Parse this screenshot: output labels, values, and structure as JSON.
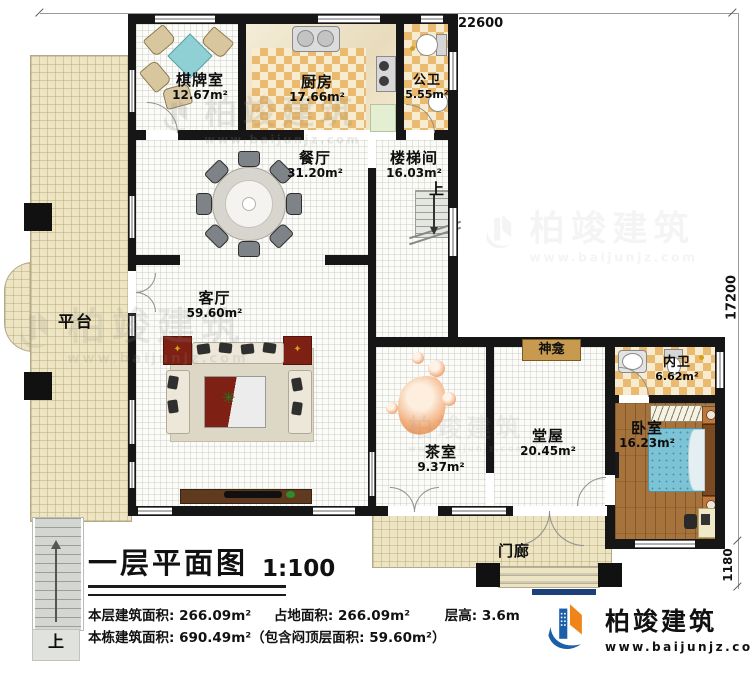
{
  "plan": {
    "dims": {
      "width_top": "22600",
      "height_right": "17200",
      "porch_depth": "1180"
    },
    "rooms": [
      {
        "name": "棋牌室",
        "area": "12.67m²"
      },
      {
        "name": "厨房",
        "area": "17.66m²"
      },
      {
        "name": "公卫",
        "area": "5.55m²"
      },
      {
        "name": "餐厅",
        "area": "31.20m²"
      },
      {
        "name": "楼梯间",
        "area": "16.03m²"
      },
      {
        "name": "客厅",
        "area": "59.60m²"
      },
      {
        "name": "茶室",
        "area": "9.37m²"
      },
      {
        "name": "堂屋",
        "area": "20.45m²"
      },
      {
        "name": "内卫",
        "area": "6.62m²"
      },
      {
        "name": "卧室",
        "area": "16.23m²"
      }
    ],
    "labels": {
      "terrace": "平台",
      "porch": "门廊",
      "shrine": "神龛",
      "up": "上"
    }
  },
  "title_block": {
    "title": "一层平面图",
    "scale": "1:100",
    "stats": [
      "本层建筑面积: 266.09m²",
      "占地面积: 266.09m²",
      "层高: 3.6m"
    ],
    "line2": "本栋建筑面积: 690.49m²（包含闷顶层面积: 59.60m²）"
  },
  "logo": {
    "name": "柏竣建筑",
    "url": "www.baijunjz.com"
  },
  "watermark": {
    "name": "柏竣建筑",
    "url": "www.baijunjz.com"
  },
  "colors": {
    "wall": "#161616",
    "terrace": "#ece4c2",
    "tile": "#e9ba70",
    "wood": "#a6733c",
    "brand_blue": "#1b5ea9",
    "brand_orange": "#f08419"
  }
}
